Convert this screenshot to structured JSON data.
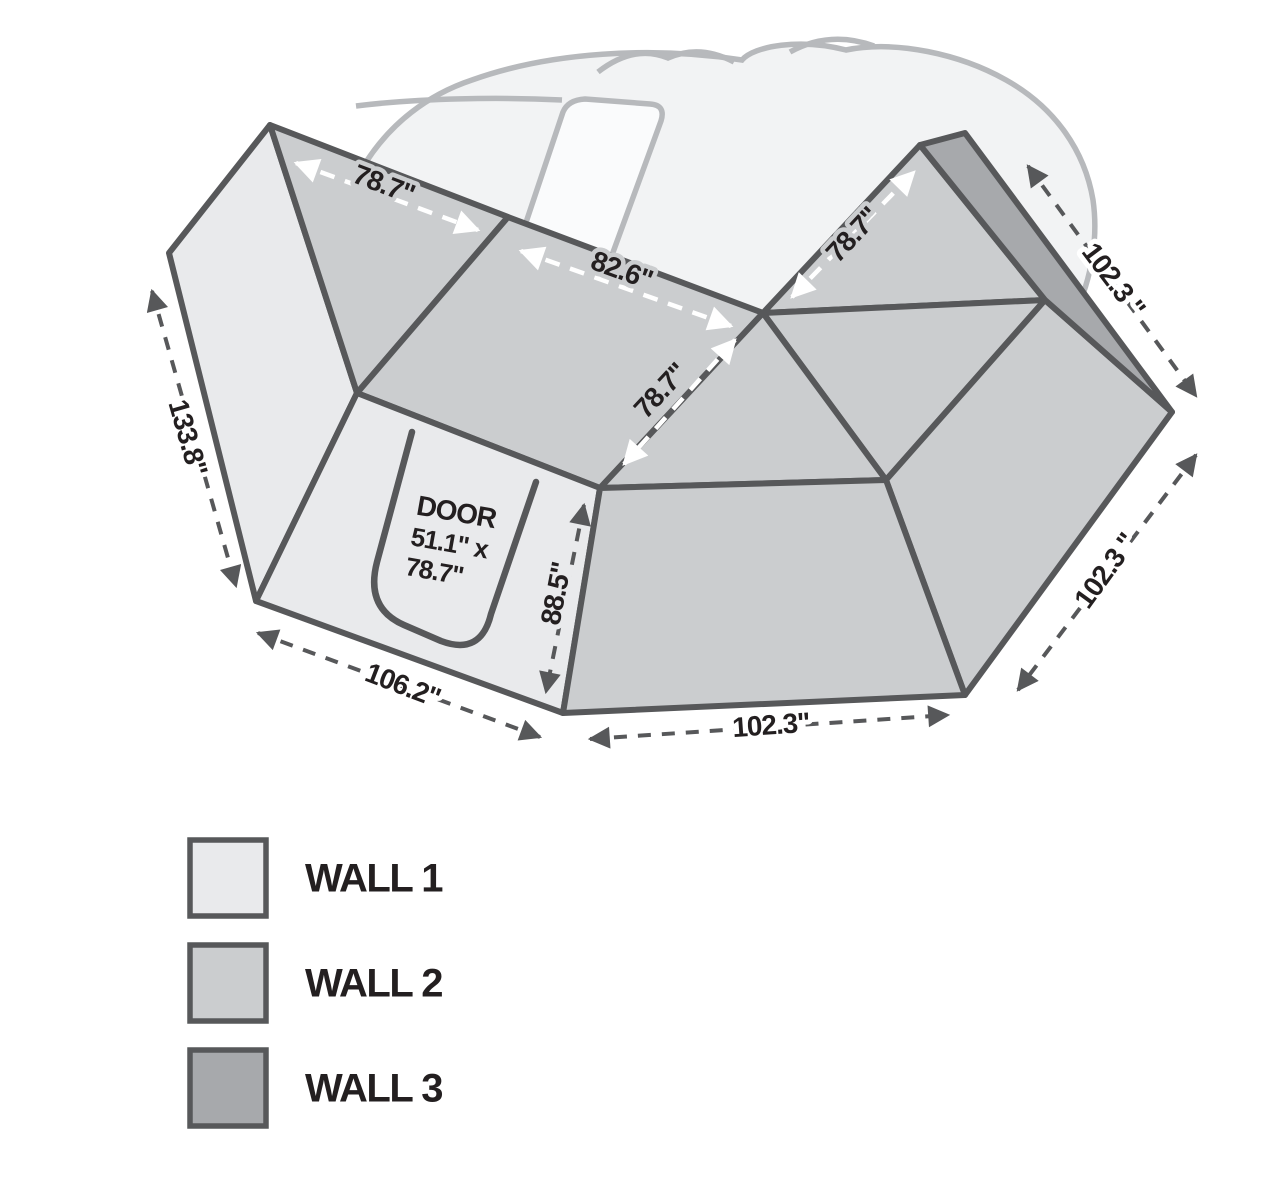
{
  "colors": {
    "wall1": "#e9eaec",
    "wall2": "#cbcdcf",
    "wall3": "#a7a9ac",
    "outline": "#57585a",
    "dimension_arrow": "#57585a",
    "label_text": "#231f20",
    "white_arrow": "#ffffff",
    "ghost_stroke": "#b7b9bc",
    "ghost_fill": "#f2f3f4",
    "blade_fill": "#fafbfc",
    "background": "#ffffff"
  },
  "dimensions": {
    "wall1_top_width": "78.7\"",
    "wall2_top_width": "82.6\"",
    "wall2_slant_height": "78.7\"",
    "wall2_right_width": "78.7\"",
    "top_right_edge": "102.3 \"",
    "left_edge": "133.8\"",
    "bottom_left_edge": "106.2\"",
    "door_panel_height": "88.5\"",
    "bottom_edge": "102.3\"",
    "lower_right_edge": "102.3 \""
  },
  "door": {
    "title": "DOOR",
    "width_line": "51.1\" x",
    "height_line": "78.7\""
  },
  "legend": {
    "items": [
      {
        "label": "WALL 1",
        "color": "#e9eaec"
      },
      {
        "label": "WALL 2",
        "color": "#cbcdcf"
      },
      {
        "label": "WALL 3",
        "color": "#a7a9ac"
      }
    ]
  }
}
